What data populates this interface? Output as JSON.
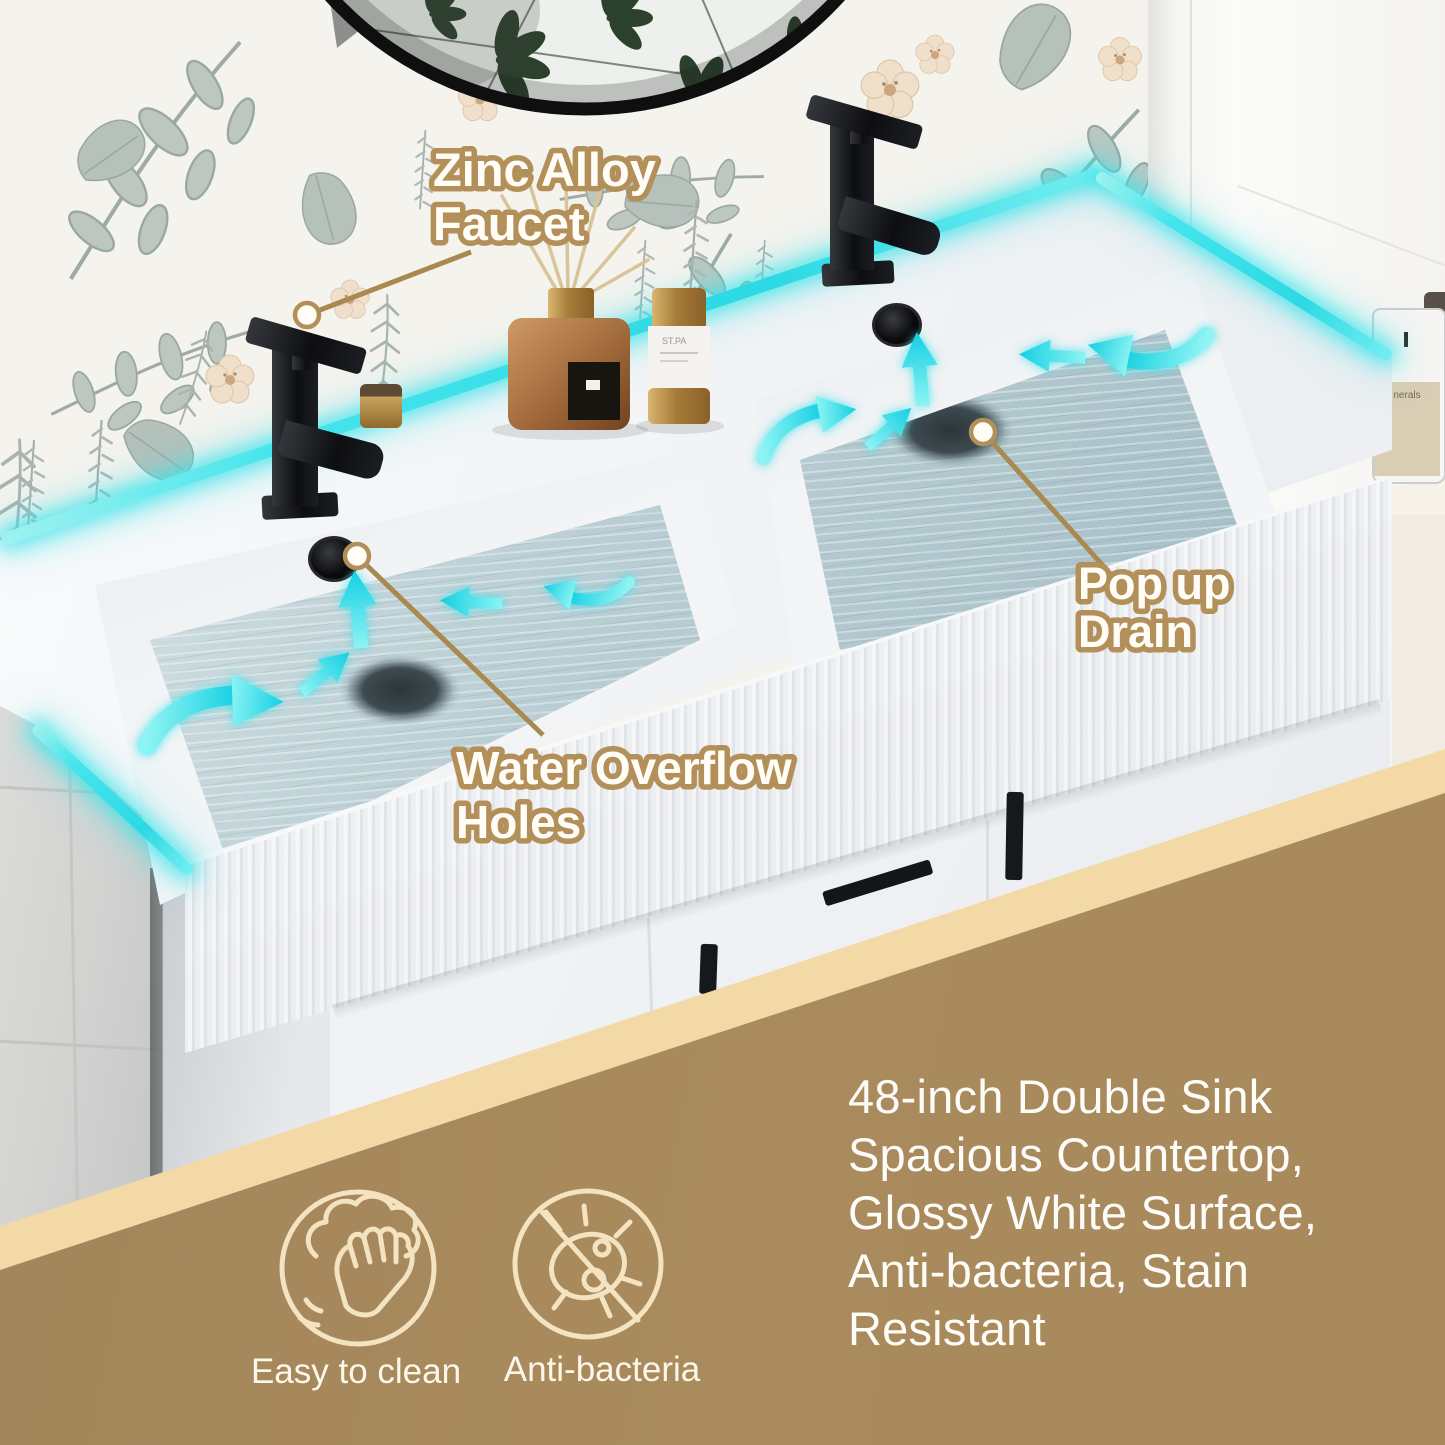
{
  "callouts": {
    "faucet": {
      "line1": "Zinc Alloy",
      "line2": "Faucet"
    },
    "overflow": {
      "line1": "Water Overflow",
      "line2": "Holes"
    },
    "drain": {
      "line1": "Pop up",
      "line2": "Drain"
    }
  },
  "features": [
    {
      "label": "Easy to clean",
      "icon": "hand-wipe-icon"
    },
    {
      "label": "Anti-bacteria",
      "icon": "no-bacteria-icon"
    }
  ],
  "description": {
    "lines": [
      "48-inch Double Sink",
      "Spacious Countertop,",
      "Glossy White Surface,",
      "Anti-bacteria, Stain",
      "Resistant"
    ]
  },
  "props": {
    "spray_bottle_label": "ST.PA",
    "candle_label": "nerals"
  },
  "colors": {
    "callout_outline": "#b3905a",
    "leader_line": "#a8894f",
    "band_brown": "#a7895b",
    "band_cream": "#f3d9a6",
    "glow_cyan": "#3fe3ea",
    "arrow_cyan": "#2bd9e6",
    "water": "#b9ced4",
    "icon_cream": "#f3e3c0",
    "description_text": "#fdfcf8"
  }
}
